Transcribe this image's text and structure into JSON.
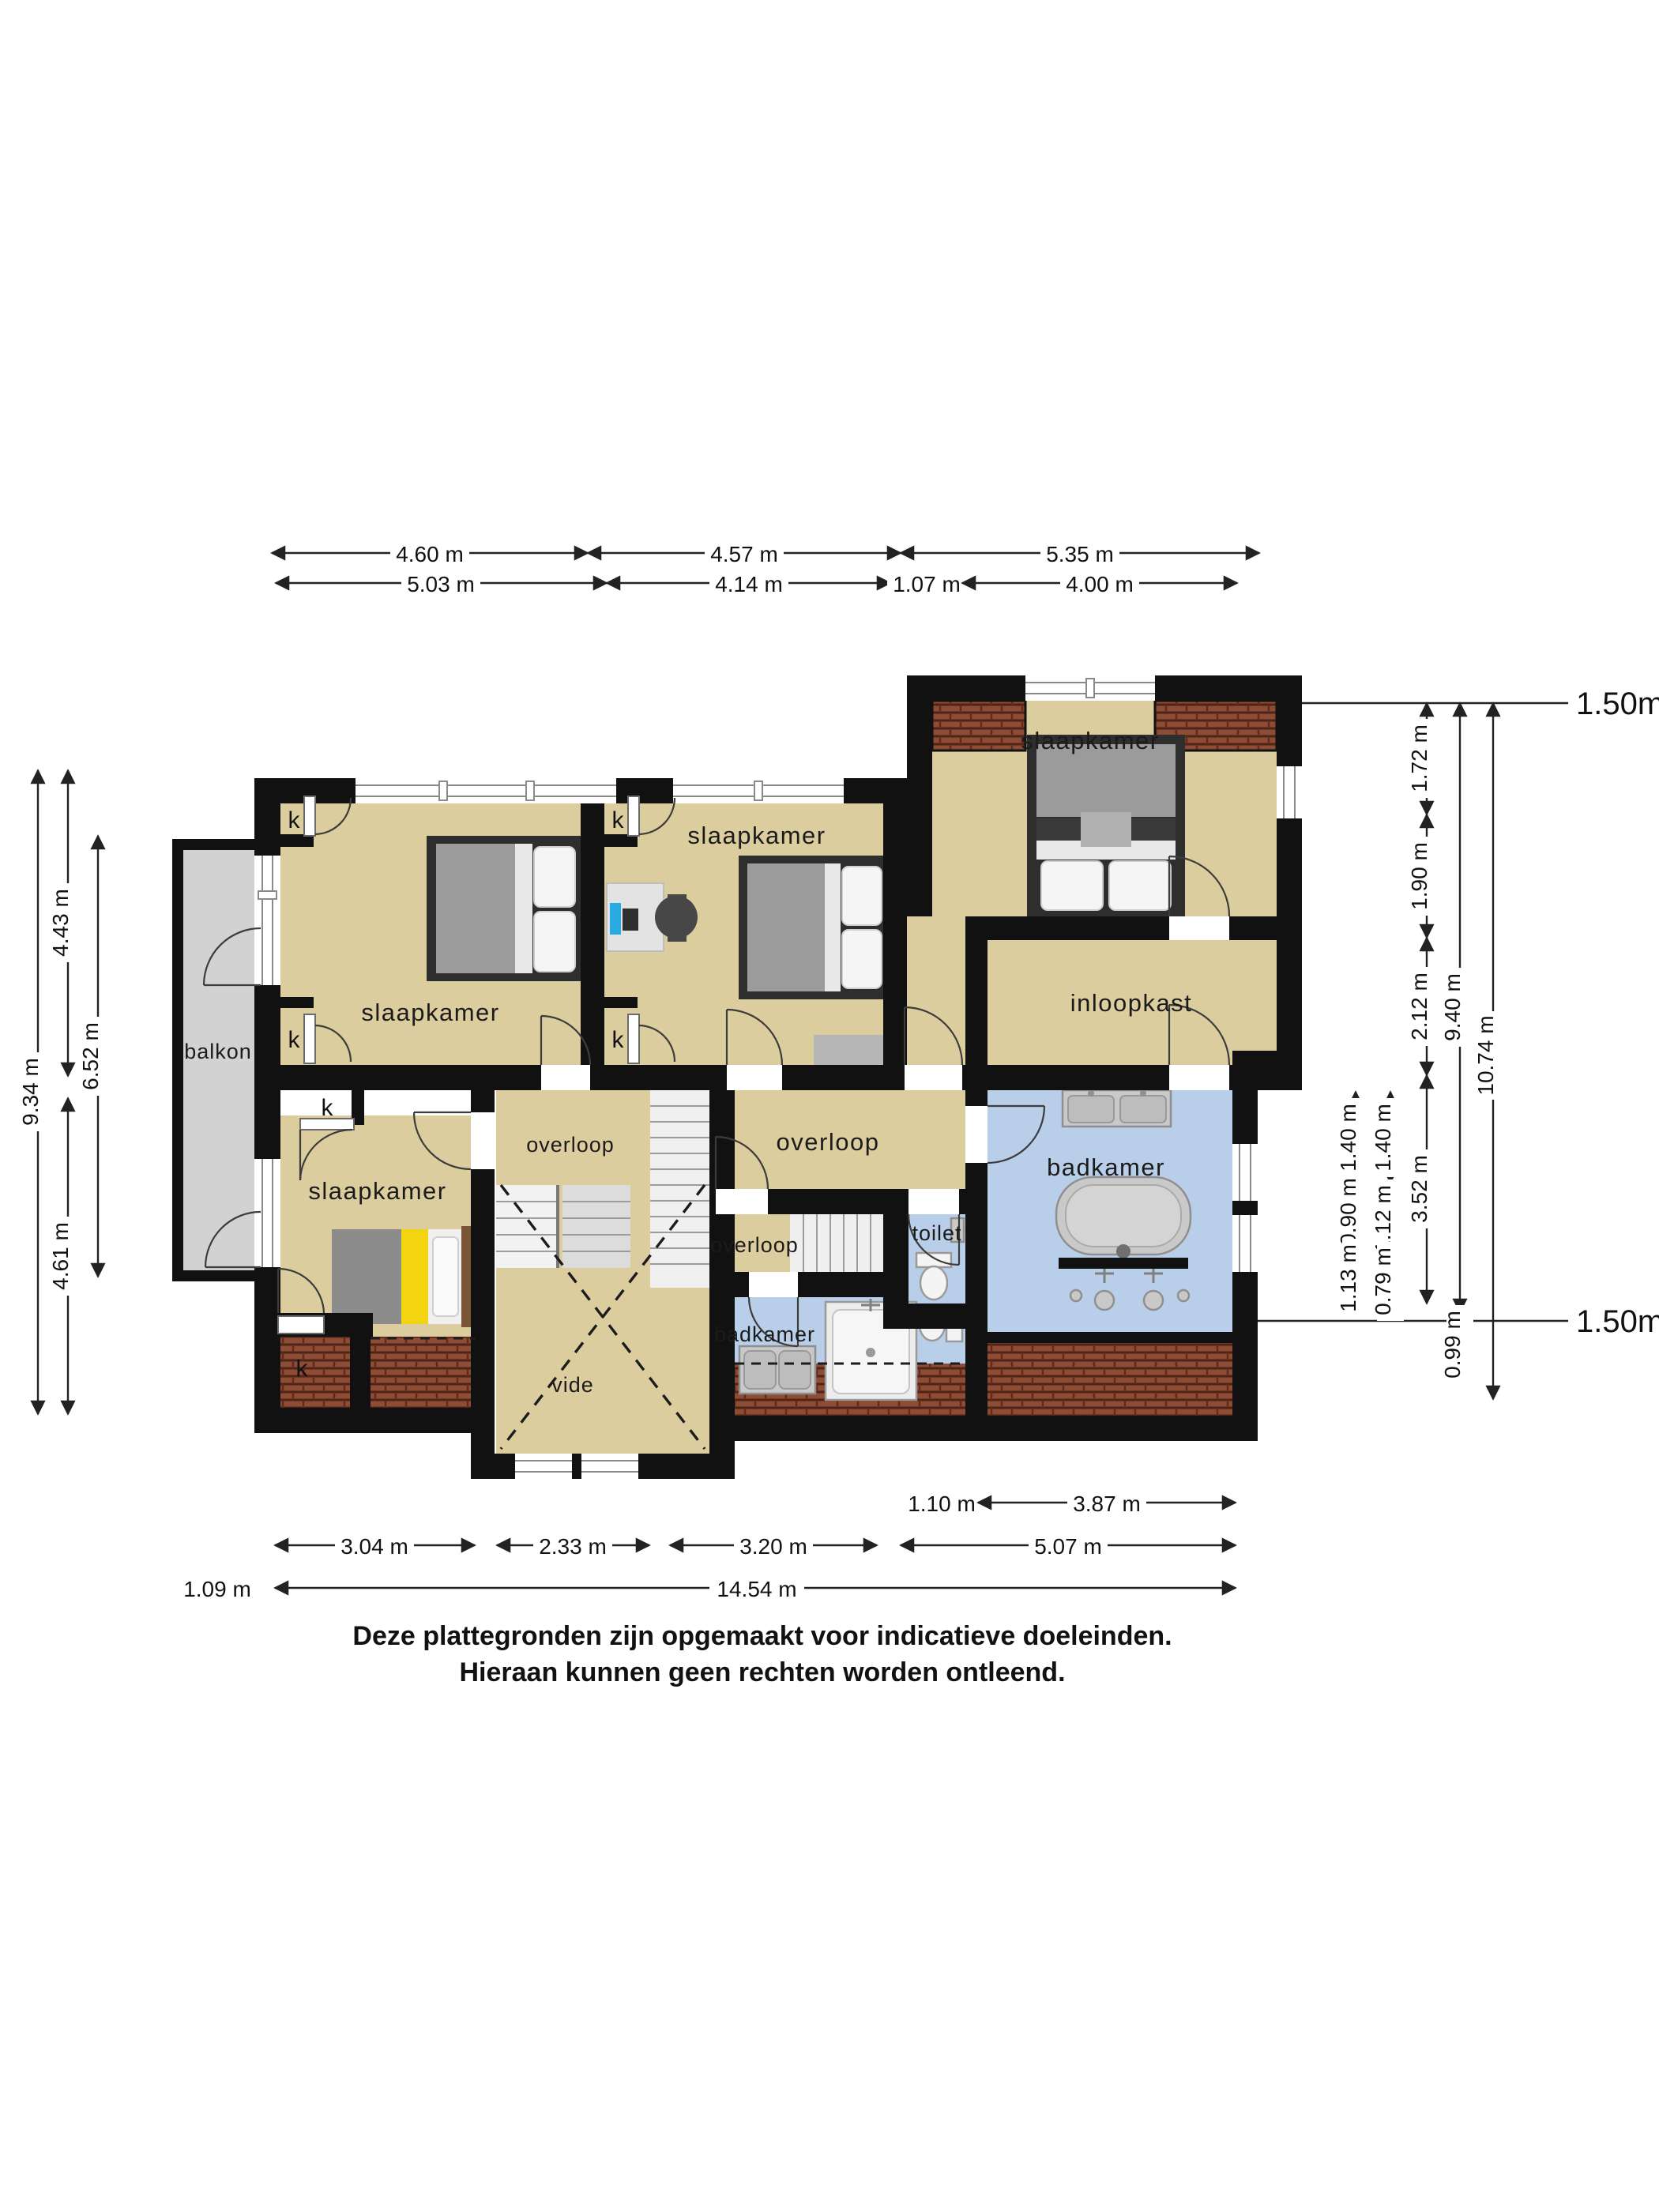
{
  "labels": {
    "bedroom": "slaapkamer",
    "balcony": "balkon",
    "walkin_closet": "inloopkast",
    "landing": "overloop",
    "toilet": "toilet",
    "bathroom": "badkamer",
    "void": "vide",
    "closet": "k"
  },
  "dims": {
    "top1": [
      "4.60 m",
      "4.57 m",
      "5.35 m"
    ],
    "top2": [
      "5.03 m",
      "4.14 m",
      "1.07 m",
      "4.00 m"
    ],
    "bottom1": [
      "1.10 m",
      "3.87 m"
    ],
    "bottom2": [
      "3.04 m",
      "2.33 m",
      "3.20 m",
      "5.07 m"
    ],
    "bottom3": [
      "1.09 m",
      "14.54 m"
    ],
    "left": [
      "9.34 m",
      "4.43 m",
      "4.61 m",
      "6.52 m"
    ],
    "right_a": [
      "1.40 m",
      "0.90 m",
      "1.13 m"
    ],
    "right_b": [
      "1.40 m",
      "1.12 m",
      "0.79 m"
    ],
    "right_c": [
      "1.72 m",
      "1.90 m",
      "2.12 m",
      "3.52 m"
    ],
    "right_d": [
      "9.40 m",
      "0.99 m"
    ],
    "right_e": [
      "10.74 m"
    ],
    "line150_top": "1.50m lijn",
    "line150_bottom": "1.50m lijn"
  },
  "footer": {
    "line1": "Deze plattegronden zijn opgemaakt voor indicatieve doeleinden.",
    "line2": "Hieraan kunnen geen rechten worden ontleend."
  },
  "colors": {
    "floor": "#dccd9e",
    "bathroom_floor": "#b9cfe9",
    "balcony_floor": "#d2d2d2",
    "wall": "#111111",
    "roof_tile": "#8e4c35"
  }
}
